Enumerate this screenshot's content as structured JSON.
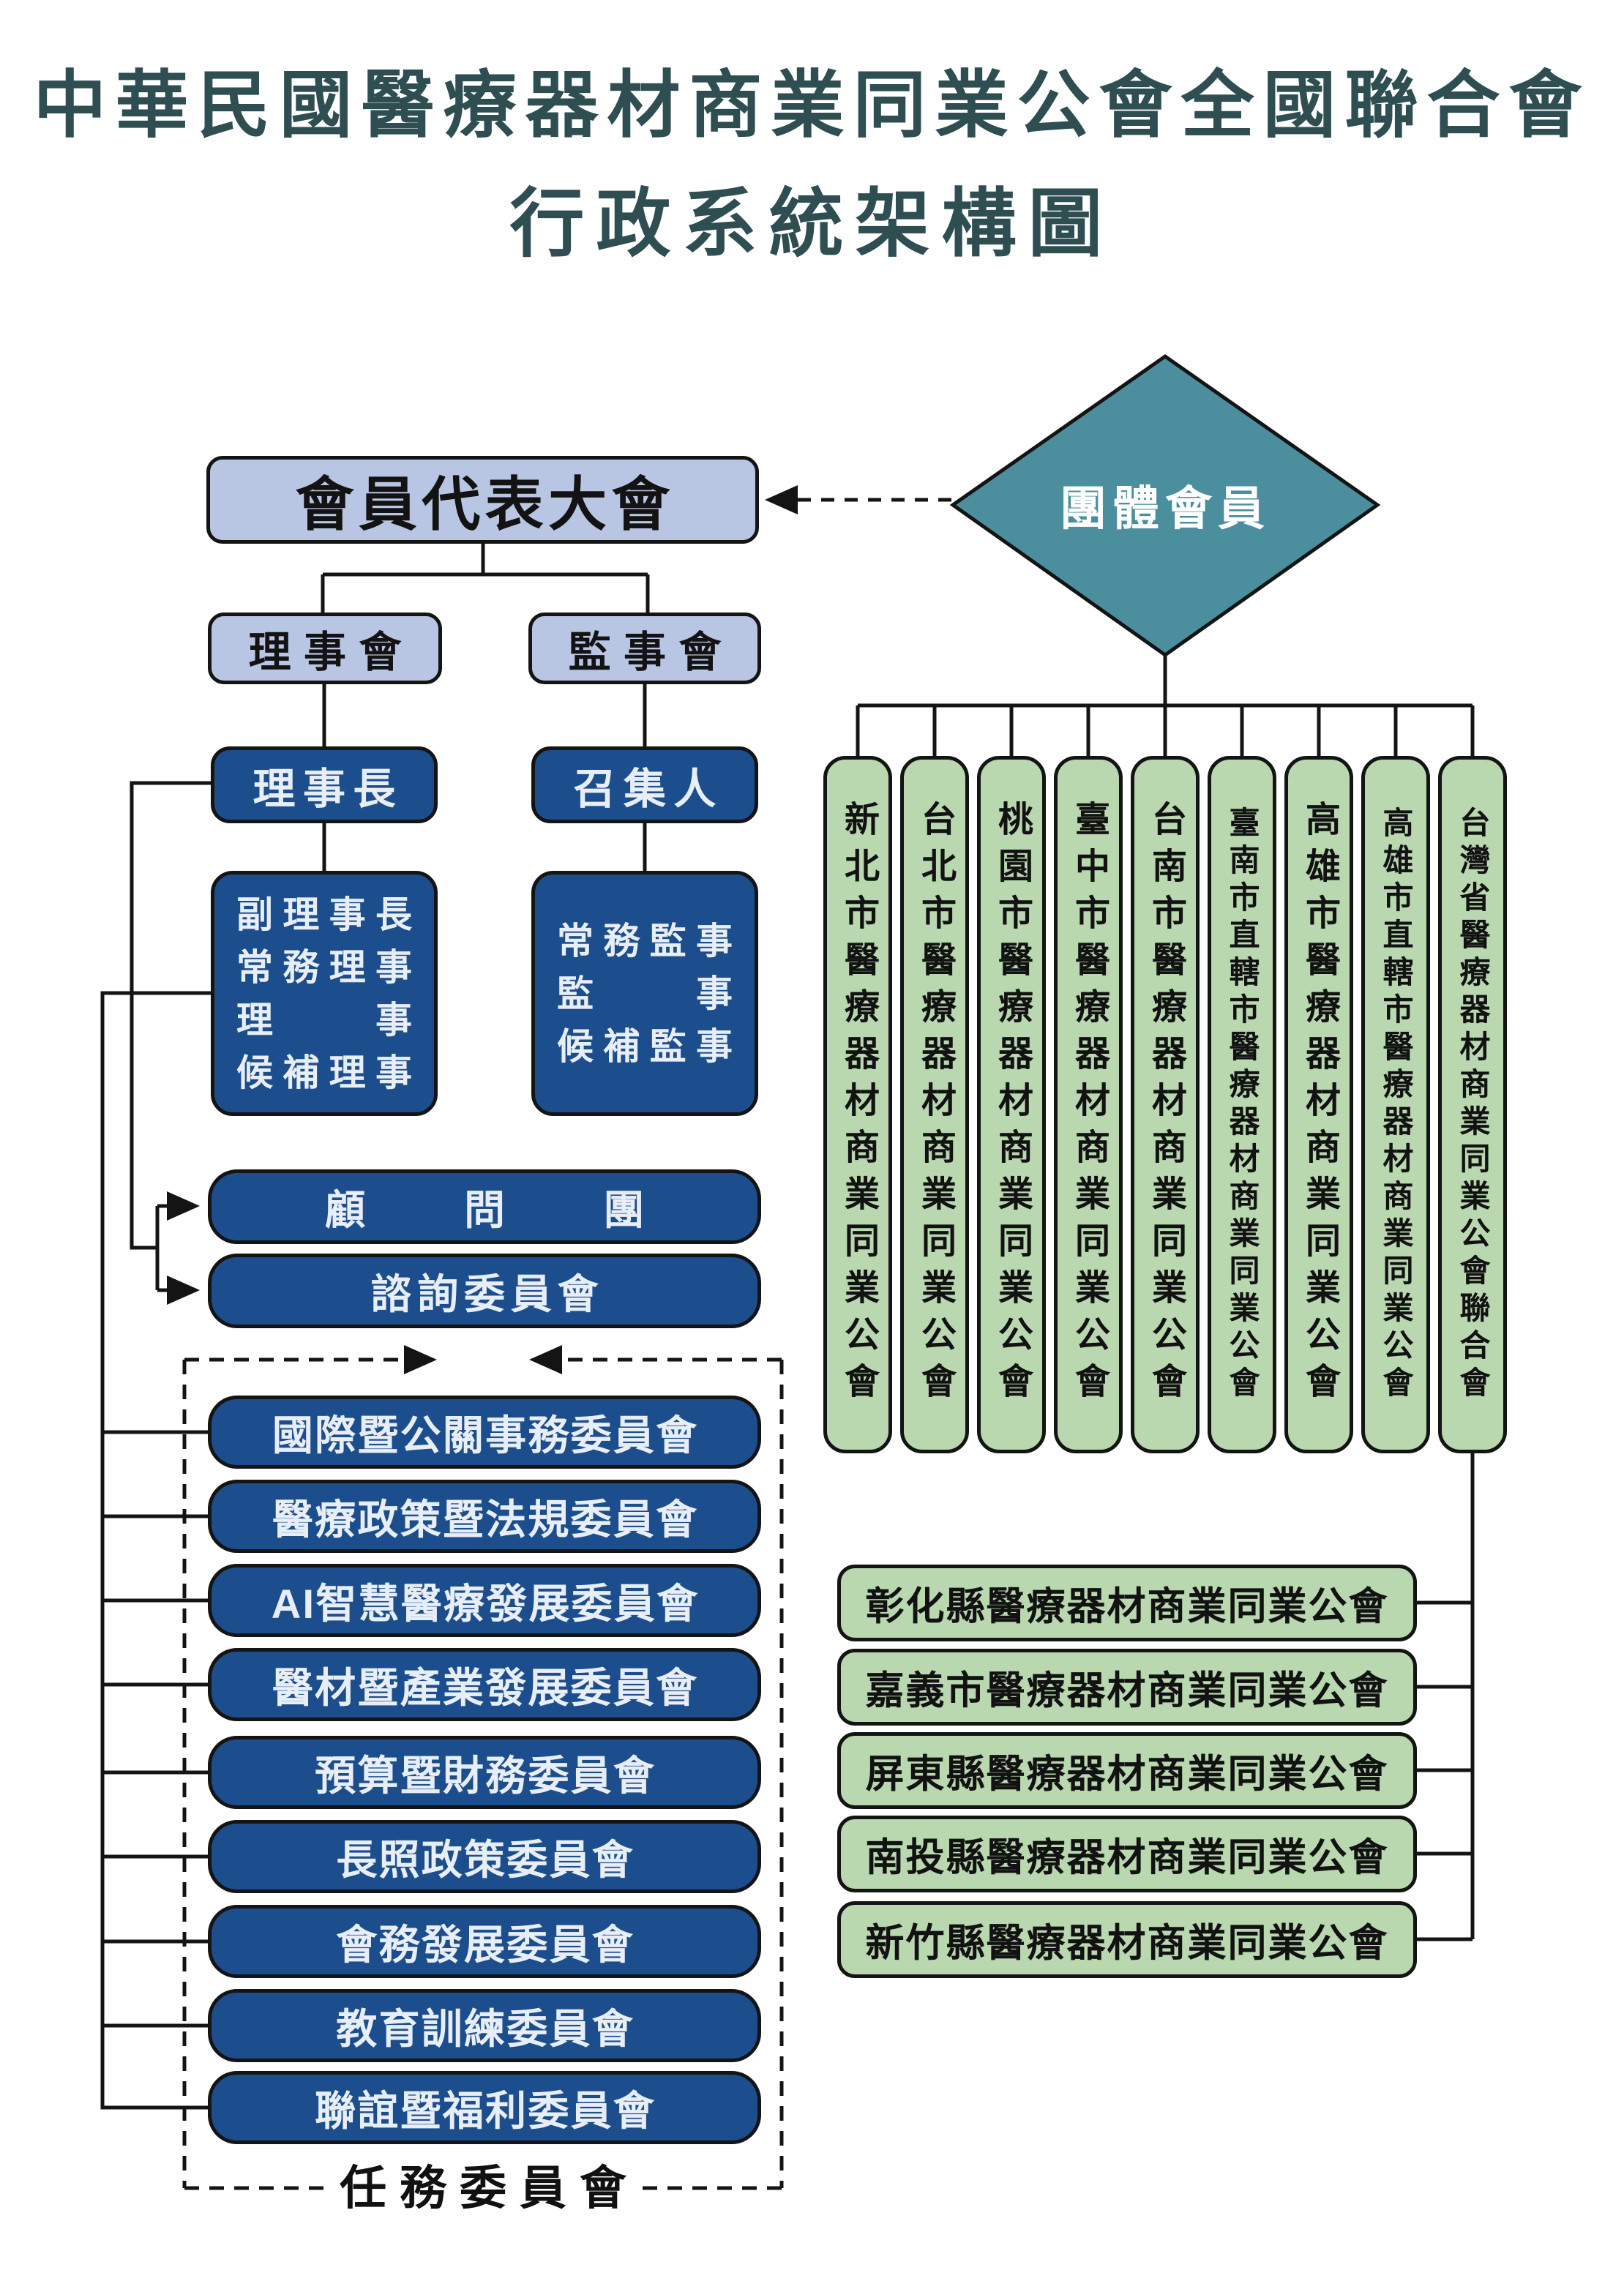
{
  "title": {
    "line1": "中華民國醫療器材商業同業公會全國聯合會",
    "line2": "行政系統架構圖"
  },
  "left": {
    "assembly": "會員代表大會",
    "board_of_directors": "理事會",
    "board_of_supervisors": "監事會",
    "chairman": "理事長",
    "convener": "召集人",
    "directors_lines": [
      "副理事長",
      "常務理事",
      "理事",
      "候補理事"
    ],
    "supervisors_lines": [
      "常務監事",
      "監事",
      "候補監事"
    ],
    "advisors_group": "顧問團",
    "advisory_committee": "諮詢委員會",
    "task_committees": [
      "國際暨公關事務委員會",
      "醫療政策暨法規委員會",
      "AI智慧醫療發展委員會",
      "醫材暨產業發展委員會",
      "預算暨財務委員會",
      "長照政策委員會",
      "會務發展委員會",
      "教育訓練委員會",
      "聯誼暨福利委員會"
    ],
    "task_committees_label": "任務委員會"
  },
  "right": {
    "group_member": "團體會員",
    "city_associations": [
      "新北市醫療器材商業同業公會",
      "台北市醫療器材商業同業公會",
      "桃園市醫療器材商業同業公會",
      "臺中市醫療器材商業同業公會",
      "台南市醫療器材商業同業公會",
      "臺南市直轄市醫療器材商業同業公會",
      "高雄市醫療器材商業同業公會",
      "高雄市直轄市醫療器材商業同業公會",
      "台灣省醫療器材商業同業公會聯合會"
    ],
    "county_associations": [
      "彰化縣醫療器材商業同業公會",
      "嘉義市醫療器材商業同業公會",
      "屏東縣醫療器材商業同業公會",
      "南投縣醫療器材商業同業公會",
      "新竹縣醫療器材商業同業公會"
    ]
  },
  "colors": {
    "title_text": "#2e4e52",
    "box_light_blue": "#b9c6e3",
    "box_dark_blue": "#1c4e8d",
    "box_green": "#b9d8b0",
    "diamond_teal": "#4b8f9e",
    "dark_box_text": "#e8eef8",
    "line": "#141414"
  }
}
